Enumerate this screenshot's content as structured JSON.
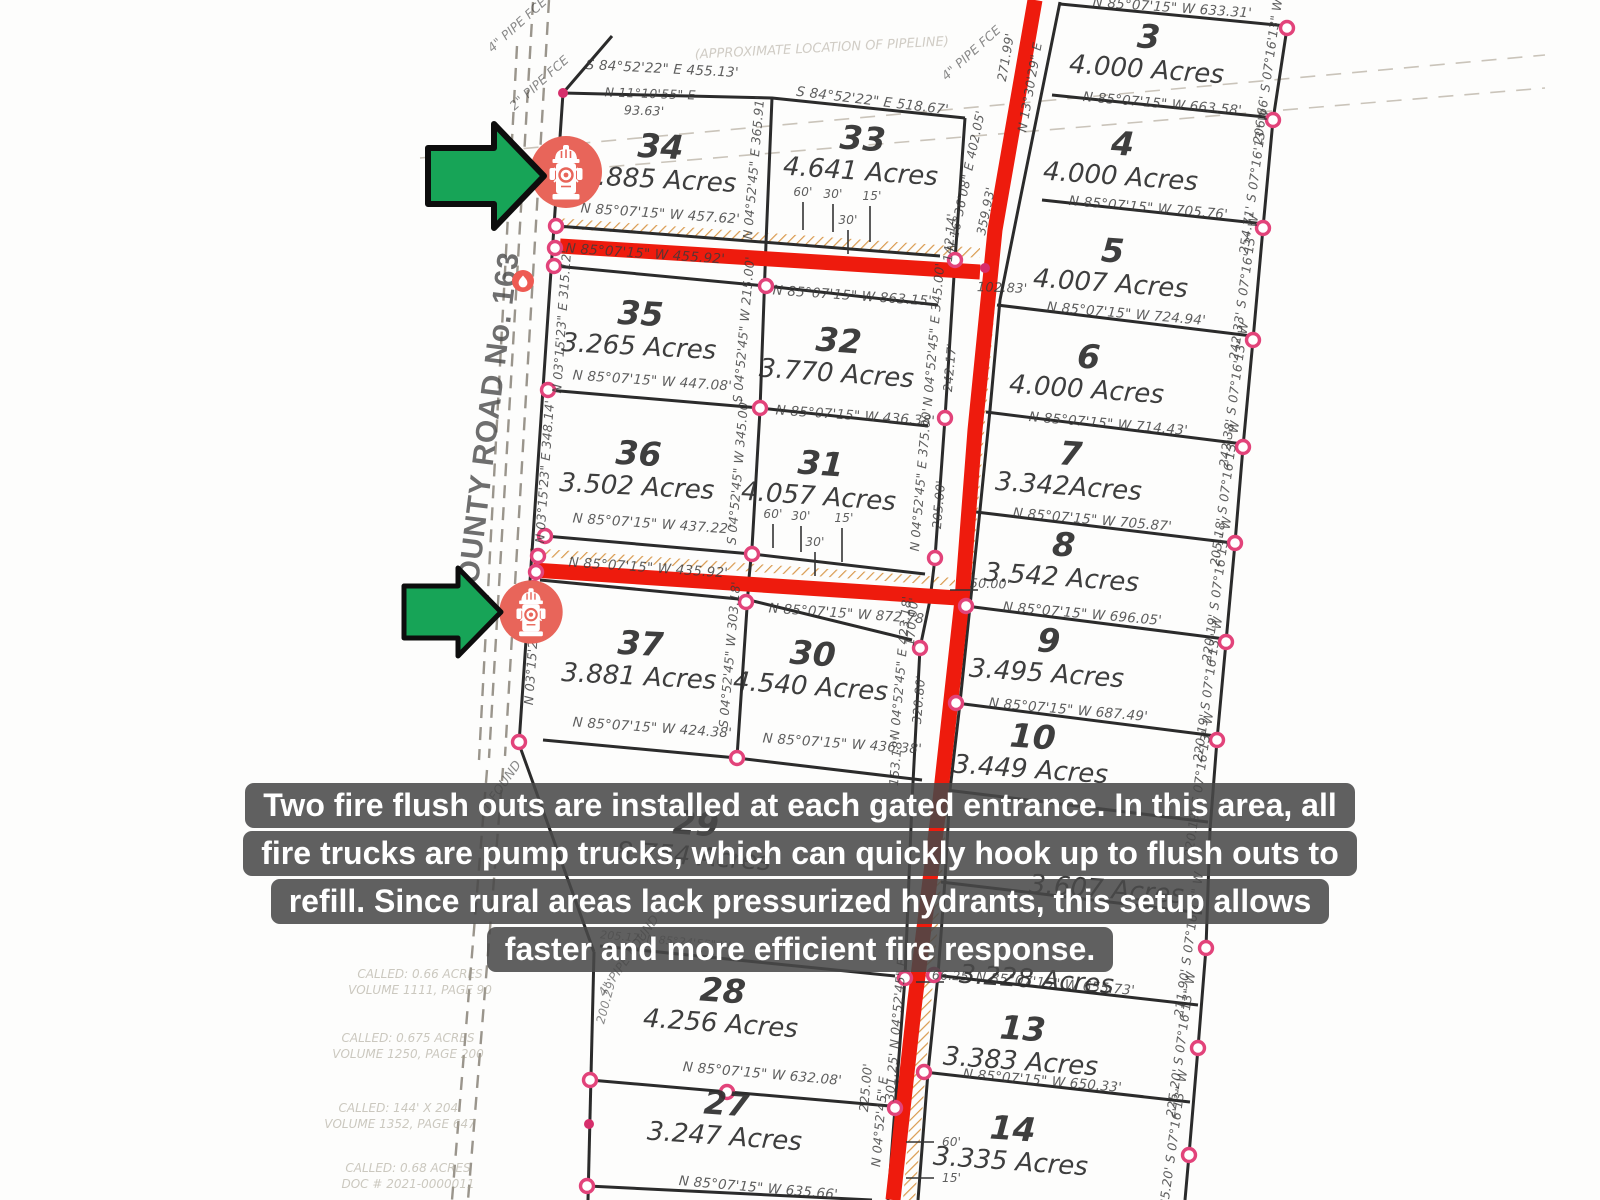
{
  "caption": {
    "lines": [
      "Two fire flush outs are installed at each gated entrance. In this area, all",
      "fire trucks are pump trucks, which can quickly hook up to flush outs to",
      "refill. Since rural areas lack pressurized hydrants, this setup allows",
      "faster and more efficient fire response."
    ]
  },
  "icons": {
    "hydrant": "fire-hydrant-icon",
    "flame": "flame-icon",
    "arrow": "green-arrow-icon"
  },
  "colors": {
    "road_red": "#ee1b0d",
    "hatch_tan": "#d99a4e",
    "marker_salmon": "#e8655a",
    "arrow_green": "#17a457",
    "vertex_pink": "#e2437a",
    "caption_bg": "#484848",
    "caption_text": "#ffffff"
  },
  "map": {
    "road_name": "COUNTY ROAD No. 163",
    "lots": [
      {
        "n": "34",
        "a": "3.885 Acres",
        "x": 660,
        "y": 158,
        "r": 3
      },
      {
        "n": "33",
        "a": "4.641 Acres",
        "x": 862,
        "y": 150,
        "r": 4
      },
      {
        "n": "35",
        "a": "3.265 Acres",
        "x": 640,
        "y": 325,
        "r": 3
      },
      {
        "n": "32",
        "a": "3.770 Acres",
        "x": 838,
        "y": 352,
        "r": 4
      },
      {
        "n": "36",
        "a": "3.502 Acres",
        "x": 638,
        "y": 465,
        "r": 3
      },
      {
        "n": "31",
        "a": "4.057 Acres",
        "x": 820,
        "y": 475,
        "r": 4
      },
      {
        "n": "37",
        "a": "3.881 Acres",
        "x": 640,
        "y": 655,
        "r": 3
      },
      {
        "n": "30",
        "a": "4.540 Acres",
        "x": 812,
        "y": 665,
        "r": 4
      },
      {
        "n": "29",
        "a": "8.754 Acres",
        "x": 695,
        "y": 835,
        "r": 4
      },
      {
        "n": "28",
        "a": "4.256 Acres",
        "x": 722,
        "y": 1002,
        "r": 4
      },
      {
        "n": "27",
        "a": "3.247 Acres",
        "x": 726,
        "y": 1115,
        "r": 4
      },
      {
        "n": "3",
        "a": "4.000 Acres",
        "x": 1148,
        "y": 48,
        "r": 4
      },
      {
        "n": "4",
        "a": "4.000 Acres",
        "x": 1122,
        "y": 155,
        "r": 4
      },
      {
        "n": "5",
        "a": "4.007 Acres",
        "x": 1112,
        "y": 262,
        "r": 4
      },
      {
        "n": "6",
        "a": "4.000 Acres",
        "x": 1088,
        "y": 368,
        "r": 4
      },
      {
        "n": "7",
        "a": "3.342Acres",
        "x": 1070,
        "y": 465,
        "r": 4
      },
      {
        "n": "8",
        "a": "3.542 Acres",
        "x": 1063,
        "y": 556,
        "r": 4
      },
      {
        "n": "9",
        "a": "3.495 Acres",
        "x": 1048,
        "y": 652,
        "r": 4
      },
      {
        "n": "10",
        "a": "3.449 Acres",
        "x": 1032,
        "y": 748,
        "r": 4
      },
      {
        "n": "",
        "a": "3.607 Acres",
        "x": 1108,
        "y": 868,
        "r": 4
      },
      {
        "n": "",
        "a": "3.228 Acres",
        "x": 1038,
        "y": 958,
        "r": 4
      },
      {
        "n": "13",
        "a": "3.383 Acres",
        "x": 1022,
        "y": 1040,
        "r": 4
      },
      {
        "n": "14",
        "a": "3.335 Acres",
        "x": 1012,
        "y": 1140,
        "r": 4
      }
    ],
    "texts": [
      {
        "t": "S 84°52'22\" E  455.13'",
        "x": 662,
        "y": 73,
        "r": 3
      },
      {
        "t": "N 11°10'55\" E",
        "x": 650,
        "y": 98,
        "r": 2,
        "s": 12.5
      },
      {
        "t": "93.63'",
        "x": 644,
        "y": 115,
        "r": 2,
        "s": 12.5
      },
      {
        "t": "S 84°52'22\" E  518.67'",
        "x": 872,
        "y": 105,
        "r": 7
      },
      {
        "t": "N 85°07'15\" W  457.62'",
        "x": 660,
        "y": 218,
        "r": 4
      },
      {
        "t": "N 85°07'15\" W  455.92'",
        "x": 645,
        "y": 258,
        "r": 4
      },
      {
        "t": "N 85°07'15\" W  863.15'",
        "x": 852,
        "y": 300,
        "r": 4
      },
      {
        "t": "N 85°07'15\" W  447.08'",
        "x": 652,
        "y": 385,
        "r": 4
      },
      {
        "t": "N 85°07'15\" W  436.38'",
        "x": 855,
        "y": 420,
        "r": 4
      },
      {
        "t": "N 85°07'15\" W  437.22'",
        "x": 652,
        "y": 528,
        "r": 4
      },
      {
        "t": "N 85°07'15\" W  435.92'",
        "x": 648,
        "y": 572,
        "r": 4
      },
      {
        "t": "N 85°07'15\" W  872.78'",
        "x": 848,
        "y": 618,
        "r": 4
      },
      {
        "t": "N 85°07'15\" W  424.38'",
        "x": 652,
        "y": 732,
        "r": 4
      },
      {
        "t": "N 85°07'15\" W  436.38'",
        "x": 842,
        "y": 748,
        "r": 4
      },
      {
        "t": "N 85°07'15\" W  632.08'",
        "x": 762,
        "y": 1078,
        "r": 5
      },
      {
        "t": "N 85°07'15\" W  635.66'",
        "x": 758,
        "y": 1192,
        "r": 5
      },
      {
        "t": "N 85°07'15\" W  633.31'",
        "x": 1172,
        "y": 12,
        "r": 4
      },
      {
        "t": "N 85°07'15\" W  663.58'",
        "x": 1162,
        "y": 108,
        "r": 5
      },
      {
        "t": "N 85°07'15\" W  705.76'",
        "x": 1148,
        "y": 212,
        "r": 5
      },
      {
        "t": "N 85°07'15\" W  724.94'",
        "x": 1126,
        "y": 318,
        "r": 5
      },
      {
        "t": "N 85°07'15\" W  714.43'",
        "x": 1108,
        "y": 428,
        "r": 5
      },
      {
        "t": "N 85°07'15\" W  705.87'",
        "x": 1092,
        "y": 524,
        "r": 5
      },
      {
        "t": "N 85°07'15\" W  696.05'",
        "x": 1082,
        "y": 618,
        "r": 5
      },
      {
        "t": "N 85°07'15\" W  687.49'",
        "x": 1068,
        "y": 714,
        "r": 5
      },
      {
        "t": "N 85°07'15\" W  655.73'",
        "x": 1055,
        "y": 988,
        "r": 5
      },
      {
        "t": "N 85°07'15\" W  650.33'",
        "x": 1042,
        "y": 1085,
        "r": 5
      },
      {
        "t": "205.17'  N 85°24'55\" W",
        "x": 665,
        "y": 944,
        "r": 5,
        "s": 11,
        "o": 0.55
      },
      {
        "t": "102.83'",
        "x": 1002,
        "y": 292,
        "r": 2,
        "s": 13
      },
      {
        "t": "50.00'",
        "x": 990,
        "y": 588,
        "r": 2,
        "s": 12.5
      },
      {
        "t": "66.25'",
        "x": 952,
        "y": 980,
        "r": 2,
        "s": 12.5
      },
      {
        "t": "206.66'  S 07°16'13\" W",
        "x": 1272,
        "y": 72,
        "r": -82,
        "s": 12.5
      },
      {
        "t": "254.71'  S 07°16'13\" W",
        "x": 1258,
        "y": 182,
        "r": -82,
        "s": 12.5
      },
      {
        "t": "242.33'  S 07°16'13\" W",
        "x": 1248,
        "y": 288,
        "r": -82,
        "s": 12.5
      },
      {
        "t": "242.38'  S 07°16'13\" W",
        "x": 1238,
        "y": 395,
        "r": -82,
        "s": 12.5
      },
      {
        "t": "205.18'  S 07°16'13\" W",
        "x": 1229,
        "y": 494,
        "r": -82,
        "s": 12.5
      },
      {
        "t": "220.19'  S 07°16'13\" W",
        "x": 1221,
        "y": 590,
        "r": -82,
        "s": 12.5
      },
      {
        "t": "220.19'  S 07°16'13\" W",
        "x": 1212,
        "y": 690,
        "r": -82,
        "s": 12.5
      },
      {
        "t": "220.19'  S 07°16'13\" W",
        "x": 1203,
        "y": 785,
        "r": -82,
        "s": 12.5
      },
      {
        "t": "211.90'  S 07°16'13\" W",
        "x": 1193,
        "y": 945,
        "r": -82,
        "s": 12.5
      },
      {
        "t": "225.20'  S 07°16'13\" W",
        "x": 1185,
        "y": 1045,
        "r": -82,
        "s": 12.5
      },
      {
        "t": "235.20'  S 07°16'13\" W",
        "x": 1177,
        "y": 1143,
        "r": -82,
        "s": 12.5
      },
      {
        "t": "N 03°15'23\" E  315.12'",
        "x": 566,
        "y": 322,
        "r": -86,
        "s": 12.5
      },
      {
        "t": "N 03°15'23\" E  348.14'",
        "x": 549,
        "y": 472,
        "r": -86,
        "s": 12.5
      },
      {
        "t": "N 03°15'23\" E",
        "x": 536,
        "y": 660,
        "r": -86,
        "s": 12.5
      },
      {
        "t": "N 04°52'45\" E  365.91'",
        "x": 758,
        "y": 168,
        "r": -85,
        "s": 12.5
      },
      {
        "t": "S 04°52'45\" W  215.00'",
        "x": 748,
        "y": 330,
        "r": -85,
        "s": 12.5
      },
      {
        "t": "S 04°52'45\" W  345.00'",
        "x": 742,
        "y": 472,
        "r": -85,
        "s": 12.5
      },
      {
        "t": "S 04°52'45\" W  303.18'",
        "x": 734,
        "y": 655,
        "r": -85,
        "s": 12.5
      },
      {
        "t": "N 04°52'45\" E  345.00'",
        "x": 938,
        "y": 335,
        "r": -85,
        "s": 12.5
      },
      {
        "t": "242.17'",
        "x": 954,
        "y": 368,
        "r": -85,
        "s": 12.5
      },
      {
        "t": "N 04°52'45\" E  375.00'",
        "x": 925,
        "y": 480,
        "r": -85,
        "s": 12.5
      },
      {
        "t": "205.00'",
        "x": 943,
        "y": 505,
        "r": -85,
        "s": 12.5
      },
      {
        "t": "170.00'",
        "x": 916,
        "y": 622,
        "r": -85,
        "s": 12.5
      },
      {
        "t": "N 04°52'45\" E  423.18'",
        "x": 905,
        "y": 668,
        "r": -85,
        "s": 12.5
      },
      {
        "t": "320.80'",
        "x": 923,
        "y": 700,
        "r": -85,
        "s": 12.5
      },
      {
        "t": "153.18'",
        "x": 900,
        "y": 762,
        "r": -85,
        "s": 12.5
      },
      {
        "t": "142.14'",
        "x": 954,
        "y": 238,
        "r": -85,
        "s": 12.5
      },
      {
        "t": "N 16°36'08\" E  402.05'",
        "x": 970,
        "y": 182,
        "r": -78,
        "s": 12.5
      },
      {
        "t": "359.93'",
        "x": 990,
        "y": 212,
        "r": -78,
        "s": 12.5
      },
      {
        "t": "271.99'",
        "x": 1010,
        "y": 58,
        "r": -80,
        "s": 12.5
      },
      {
        "t": "N 13°30'29\" E",
        "x": 1034,
        "y": 88,
        "r": -80,
        "s": 12.5
      },
      {
        "t": "225.00'",
        "x": 870,
        "y": 1088,
        "r": -85,
        "s": 12.5
      },
      {
        "t": "N 04°52'45\" E",
        "x": 884,
        "y": 1122,
        "r": -85,
        "s": 12.5
      },
      {
        "t": "301.25'  N 04°52'45\" E",
        "x": 900,
        "y": 1030,
        "r": -85,
        "s": 12.5
      },
      {
        "t": "200.29'",
        "x": 610,
        "y": 1002,
        "r": -75,
        "s": 12,
        "o": 0.6
      },
      {
        "t": "4\" PIPE FCE",
        "x": 520,
        "y": 28,
        "r": -42,
        "s": 12.5,
        "o": 0.6
      },
      {
        "t": "2\" PIPE FCE",
        "x": 542,
        "y": 86,
        "r": -42,
        "s": 12.5,
        "o": 0.6
      },
      {
        "t": "4\" PIPE FCE",
        "x": 974,
        "y": 56,
        "r": -42,
        "s": 12.5,
        "o": 0.6
      },
      {
        "t": "4\" PIPE FOUND",
        "x": 632,
        "y": 958,
        "r": -55,
        "s": 12.5,
        "o": 0.6
      },
      {
        "t": "T FOUND",
        "x": 505,
        "y": 788,
        "r": -55,
        "s": 12.5,
        "o": 0.6
      },
      {
        "t": "CALLED: 0.66 ACRES",
        "x": 420,
        "y": 978,
        "c": "n",
        "s": 12,
        "o": 0.55
      },
      {
        "t": "VOLUME 1111, PAGE 90",
        "x": 420,
        "y": 994,
        "c": "n",
        "s": 12,
        "o": 0.55
      },
      {
        "t": "CALLED: 0.675 ACRES",
        "x": 408,
        "y": 1042,
        "c": "n",
        "s": 12,
        "o": 0.55
      },
      {
        "t": "VOLUME 1250, PAGE 200",
        "x": 408,
        "y": 1058,
        "c": "n",
        "s": 12,
        "o": 0.55
      },
      {
        "t": "CALLED: 144' X 204'",
        "x": 400,
        "y": 1112,
        "c": "n",
        "s": 12,
        "o": 0.55
      },
      {
        "t": "VOLUME 1352, PAGE 647",
        "x": 400,
        "y": 1128,
        "c": "n",
        "s": 12,
        "o": 0.55
      },
      {
        "t": "CALLED: 0.68 ACRES",
        "x": 408,
        "y": 1172,
        "c": "n",
        "s": 12,
        "o": 0.55
      },
      {
        "t": "DOC # 2021-0000011",
        "x": 408,
        "y": 1188,
        "c": "n",
        "s": 12,
        "o": 0.55
      },
      {
        "t": "(APPROXIMATE LOCATION OF PIPELINE)",
        "x": 822,
        "y": 52,
        "r": -3,
        "c": "n",
        "s": 13,
        "o": 0.5
      },
      {
        "t": "COUNTY ROAD No. 163",
        "x": 497,
        "y": 430,
        "r": -83,
        "c": "road",
        "s": 30,
        "o": 0.8
      },
      {
        "t": "60'",
        "x": 803,
        "y": 196,
        "s": 12
      },
      {
        "t": "30'",
        "x": 833,
        "y": 198,
        "s": 12
      },
      {
        "t": "30'",
        "x": 848,
        "y": 224,
        "s": 12
      },
      {
        "t": "15'",
        "x": 872,
        "y": 200,
        "s": 12
      },
      {
        "t": "60'",
        "x": 773,
        "y": 518,
        "s": 12
      },
      {
        "t": "30'",
        "x": 801,
        "y": 520,
        "s": 12
      },
      {
        "t": "30'",
        "x": 815,
        "y": 546,
        "s": 12
      },
      {
        "t": "15'",
        "x": 844,
        "y": 522,
        "s": 12
      },
      {
        "t": "60'",
        "x": 942,
        "y": 1146,
        "s": 12,
        "a": "s"
      },
      {
        "t": "15'",
        "x": 942,
        "y": 1182,
        "s": 12,
        "a": "s"
      }
    ],
    "segments": [
      "612,36 563,93 519,744",
      "519,744 594,952",
      "594,952 588,1200",
      "772,98 766,243 760,410 752,548 749,578 737,757",
      "563,93 772,98 965,118",
      "557,226 940,256",
      "555,266 766,286 938,305",
      "548,390 760,408 928,426",
      "545,536 752,554 925,574",
      "540,580 749,600 912,640",
      "543,740 737,758 922,780",
      "600,946 895,976",
      "590,1080 890,1106",
      "588,1186 872,1200",
      "1060,2 1020,200 1000,300 990,410 980,510 970,606 960,703 950,790 945,880 938,975 928,1072 918,1200",
      "965,118 955,260 945,418 935,558 930,600 920,648 912,802 905,978 895,1108 888,1200",
      "1060,4 1287,26",
      "1287,28 1273,120 1263,228 1253,340 1243,447 1235,543 1226,642 1217,740 1210,830 1206,948 1198,1048 1189,1155 1185,1200",
      "1052,95 1275,118",
      "1042,200 1265,224",
      "997,305 1252,336",
      "986,412 1243,444",
      "976,512 1233,543",
      "966,606 1225,639",
      "956,703 1216,736",
      "946,790 1208,822",
      "941,882 1202,913",
      "934,975 1198,1005",
      "924,1072 1190,1102"
    ],
    "roads": [
      "1035,0 995,230 975,430 962,600 940,800 915,1000 893,1200",
      "560,246 980,272",
      "533,570 958,598"
    ],
    "hatches": [
      "557,218 980,248 980,258 557,228",
      "530,548 955,578 955,586 530,556",
      "985,280 997,280 970,600 958,600",
      "958,600 970,600 948,800 936,800",
      "936,800 948,800 915,1200 903,1200"
    ],
    "dashed": [
      {
        "p": "549,0 505,756",
        "c": "county"
      },
      {
        "p": "533,2 489,758",
        "c": "county"
      },
      {
        "p": "517,46 479,760",
        "c": "county"
      },
      {
        "p": "503,768 468,1200",
        "c": "county"
      },
      {
        "p": "487,770 452,1200",
        "c": "county"
      },
      {
        "p": "420,158 1545,55",
        "c": "pipe"
      },
      {
        "p": "428,182 1545,88",
        "c": "pipe"
      }
    ],
    "ticks": [
      [
        803,
        202,
        803,
        230
      ],
      [
        833,
        204,
        833,
        232
      ],
      [
        848,
        230,
        848,
        254
      ],
      [
        870,
        206,
        870,
        242
      ],
      [
        773,
        524,
        773,
        548
      ],
      [
        801,
        526,
        801,
        552
      ],
      [
        815,
        552,
        815,
        576
      ],
      [
        842,
        528,
        842,
        562
      ],
      [
        906,
        1142,
        934,
        1142
      ],
      [
        906,
        1178,
        934,
        1178
      ],
      [
        916,
        982,
        944,
        982
      ],
      [
        950,
        590,
        978,
        590
      ]
    ],
    "vertices": [
      [
        563,
        93,
        1
      ],
      [
        558,
        162,
        1
      ],
      [
        556,
        226
      ],
      [
        555,
        248
      ],
      [
        554,
        266
      ],
      [
        548,
        390
      ],
      [
        545,
        536
      ],
      [
        538,
        556
      ],
      [
        536,
        572
      ],
      [
        534,
        588
      ],
      [
        519,
        742
      ],
      [
        590,
        1080
      ],
      [
        589,
        1124,
        1
      ],
      [
        587,
        1186
      ],
      [
        766,
        286
      ],
      [
        760,
        408
      ],
      [
        752,
        554
      ],
      [
        746,
        602
      ],
      [
        737,
        758
      ],
      [
        727,
        1092
      ],
      [
        955,
        260
      ],
      [
        945,
        418
      ],
      [
        935,
        558
      ],
      [
        920,
        648
      ],
      [
        905,
        978
      ],
      [
        895,
        1108
      ],
      [
        966,
        606
      ],
      [
        956,
        703
      ],
      [
        934,
        975
      ],
      [
        924,
        1072
      ],
      [
        1287,
        28
      ],
      [
        1273,
        120
      ],
      [
        1263,
        228
      ],
      [
        1253,
        340
      ],
      [
        1243,
        447
      ],
      [
        1235,
        543
      ],
      [
        1226,
        642
      ],
      [
        1217,
        740
      ],
      [
        1206,
        948
      ],
      [
        1198,
        1048
      ],
      [
        1189,
        1155
      ],
      [
        985,
        268,
        1
      ]
    ]
  }
}
